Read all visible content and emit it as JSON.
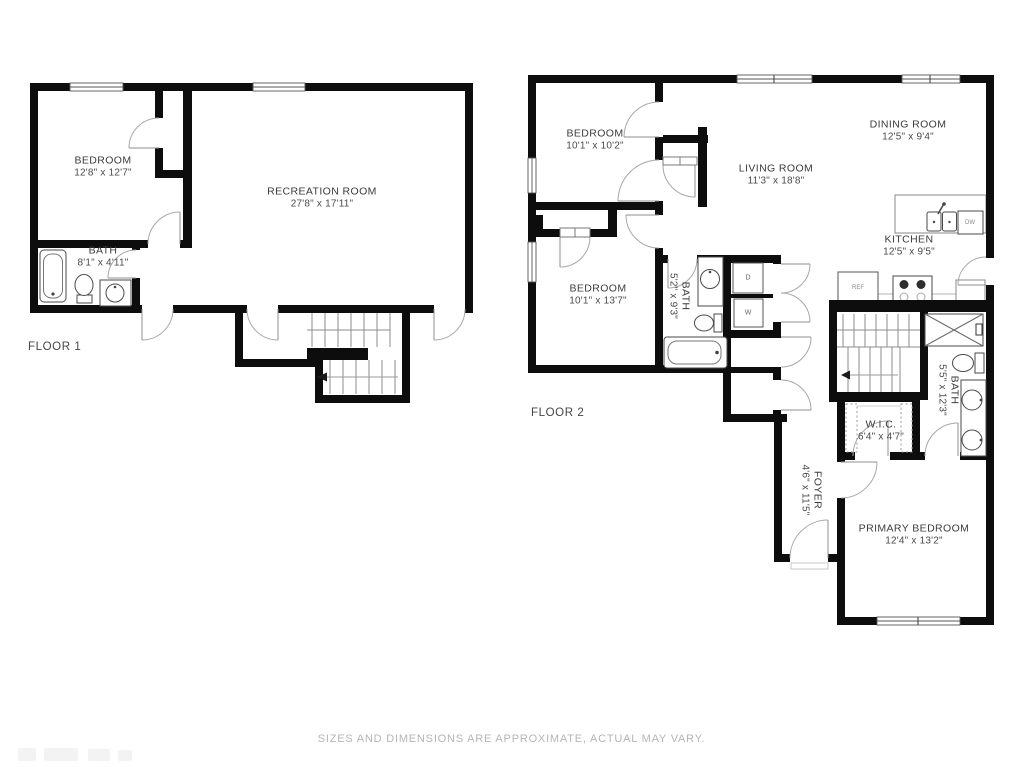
{
  "footer": {
    "disclaimer": "SIZES AND DIMENSIONS ARE APPROXIMATE, ACTUAL MAY VARY."
  },
  "floor1": {
    "label": "FLOOR 1",
    "rooms": {
      "bedroom": {
        "name": "BEDROOM",
        "dims": "12'8\" x 12'7\""
      },
      "recreation": {
        "name": "RECREATION ROOM",
        "dims": "27'8\" x 17'11\""
      },
      "bath": {
        "name": "BATH",
        "dims": "8'1\" x 4'11\""
      }
    }
  },
  "floor2": {
    "label": "FLOOR 2",
    "rooms": {
      "bedroom1": {
        "name": "BEDROOM",
        "dims": "10'1\" x 10'2\""
      },
      "dining": {
        "name": "DINING ROOM",
        "dims": "12'5\" x 9'4\""
      },
      "living": {
        "name": "LIVING ROOM",
        "dims": "11'3\" x 18'8\""
      },
      "kitchen": {
        "name": "KITCHEN",
        "dims": "12'5\" x 9'5\""
      },
      "bedroom2": {
        "name": "BEDROOM",
        "dims": "10'1\" x 13'7\""
      },
      "bath1": {
        "name": "BATH",
        "dims": "5'2\" x 9'3\""
      },
      "bath2": {
        "name": "BATH",
        "dims": "5'5\" x 12'3\""
      },
      "wic": {
        "name": "W.I.C.",
        "dims": "6'4\" x 4'7\""
      },
      "foyer": {
        "name": "FOYER",
        "dims": "4'6\" x 11'5\""
      },
      "primary": {
        "name": "PRIMARY BEDROOM",
        "dims": "12'4\" x 13'2\""
      }
    },
    "appliances": {
      "ref": "REF",
      "dw": "DW",
      "dryer": "D",
      "washer": "W"
    }
  },
  "colors": {
    "wall": "#0d0d0d",
    "fixture": "#4a4a4a",
    "door_arc": "#a8a8a8",
    "stair": "#8c8c8c"
  }
}
